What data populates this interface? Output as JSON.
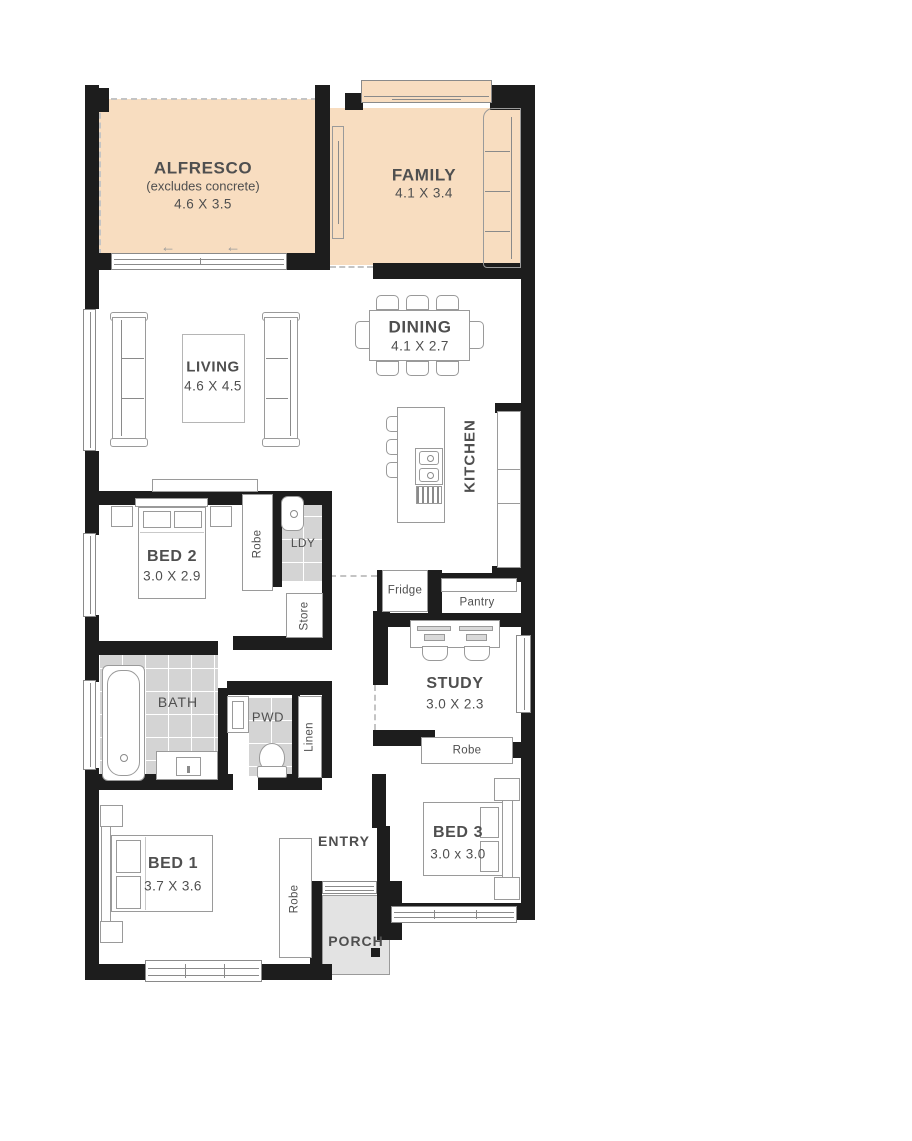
{
  "colors": {
    "highlight_room_fill": "#f8ddc0",
    "tile_fill": "#d4d4d4",
    "porch_fill": "#e3e3e3",
    "wall": "#1d1d1d",
    "furniture_line": "#9a9a9a",
    "label_text": "#4f4f4f"
  },
  "icons": {
    "slide_arrow": "←"
  },
  "rooms": {
    "alfresco": {
      "name": "ALFRESCO",
      "note": "(excludes concrete)",
      "dims": "4.6 X 3.5"
    },
    "family": {
      "name": "FAMILY",
      "dims": "4.1 X 3.4"
    },
    "dining": {
      "name": "DINING",
      "dims": "4.1 X 2.7"
    },
    "living": {
      "name": "LIVING",
      "dims": "4.6 X 4.5"
    },
    "kitchen": {
      "name": "KITCHEN"
    },
    "bed2": {
      "name": "BED 2",
      "dims": "3.0 X 2.9"
    },
    "bed3": {
      "name": "BED 3",
      "dims": "3.0 x 3.0"
    },
    "bed1": {
      "name": "BED 1",
      "dims": "3.7 X 3.6"
    },
    "study": {
      "name": "STUDY",
      "dims": "3.0 X 2.3"
    },
    "bath": {
      "name": "BATH"
    },
    "pwd": {
      "name": "PWD"
    },
    "ldy": {
      "name": "LDY"
    },
    "entry": {
      "name": "ENTRY"
    },
    "porch": {
      "name": "PORCH"
    },
    "store": {
      "name": "Store"
    },
    "linen": {
      "name": "Linen"
    },
    "fridge": {
      "name": "Fridge"
    },
    "pantry": {
      "name": "Pantry"
    },
    "robe_bed1": {
      "name": "Robe"
    },
    "robe_bed2": {
      "name": "Robe"
    },
    "robe_bed3": {
      "name": "Robe"
    }
  }
}
